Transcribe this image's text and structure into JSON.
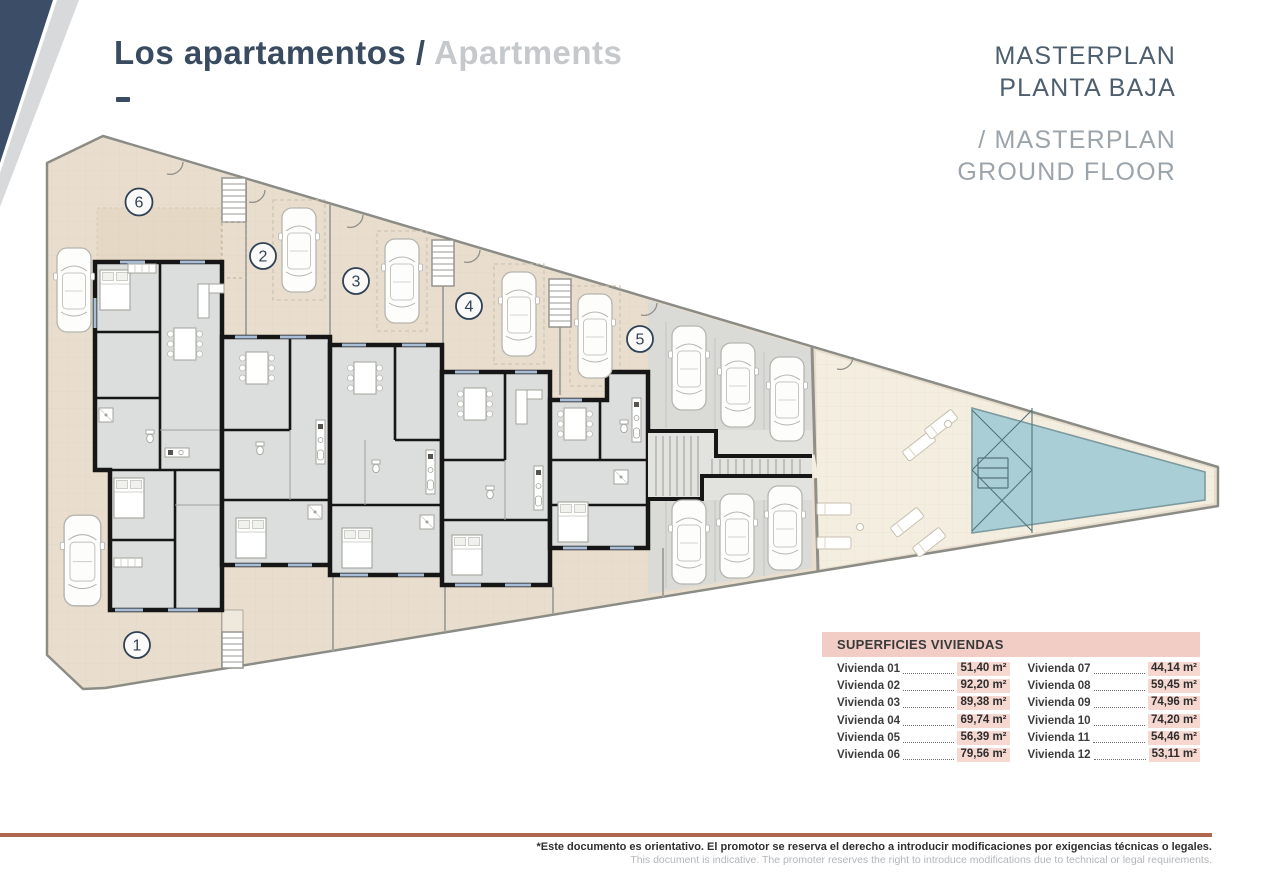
{
  "header": {
    "title_primary": "Los apartamentos /",
    "title_secondary": "Apartments"
  },
  "masterplan": {
    "line1": "MASTERPLAN",
    "line2": "PLANTA BAJA",
    "line3": "/ MASTERPLAN",
    "line4": "GROUND FLOOR"
  },
  "plan": {
    "unit_labels": {
      "u1": "1",
      "u2": "2",
      "u3": "3",
      "u4": "4",
      "u5": "5",
      "u6": "6"
    }
  },
  "table": {
    "title": "SUPERFICIES VIVIENDAS",
    "col1": [
      {
        "label": "Vivienda 01",
        "value": "51,40 m²"
      },
      {
        "label": "Vivienda 02",
        "value": "92,20 m²"
      },
      {
        "label": "Vivienda 03",
        "value": "89,38 m²"
      },
      {
        "label": "Vivienda 04",
        "value": "69,74 m²"
      },
      {
        "label": "Vivienda 05",
        "value": "56,39 m²"
      },
      {
        "label": "Vivienda 06",
        "value": "79,56 m²"
      }
    ],
    "col2": [
      {
        "label": "Vivienda 07",
        "value": "44,14 m²"
      },
      {
        "label": "Vivienda 08",
        "value": "59,45 m²"
      },
      {
        "label": "Vivienda 09",
        "value": "74,96 m²"
      },
      {
        "label": "Vivienda 10",
        "value": "74,20 m²"
      },
      {
        "label": "Vivienda 11",
        "value": "54,46 m²"
      },
      {
        "label": "Vivienda 12",
        "value": "53,11 m²"
      }
    ]
  },
  "footer": {
    "line_es": "*Este documento es orientativo. El promotor se reserva el derecho a introducir modificaciones por exigencias técnicas o legales.",
    "line_en": "This document is indicative. The promoter reserves the right to introduce modifications due to technical or legal requirements."
  },
  "colors": {
    "navy": "#394b61",
    "gray_title": "#c6c9cc",
    "site_beige": "#e9decd",
    "terrace_cream": "#f4eee1",
    "pool_blue": "#a9ced5",
    "table_pink": "#f2cdc6",
    "footer_rule": "#b0674f"
  }
}
